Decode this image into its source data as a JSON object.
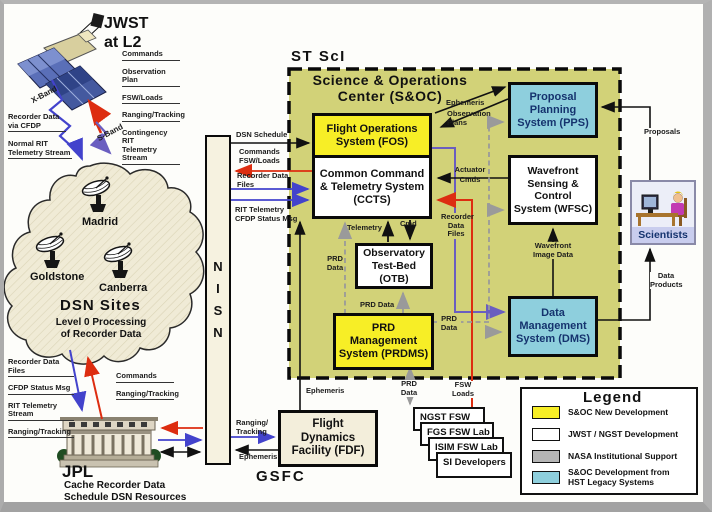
{
  "palette": {
    "soc_fill": "#d2d278",
    "new_dev_yellow": "#f7ee26",
    "hst_legacy_blue": "#8ecfdd",
    "nasa_gray": "#b5b5b5",
    "jwst_white": "#ffffff",
    "cream": "#f5f0dc",
    "red_arrow": "#dd2d10",
    "blue_arrow": "#4343cc",
    "purple_arrow": "#6a5ec0",
    "gray_dash": "#9a9a9a"
  },
  "jwst": {
    "title": "JWST\nat L2",
    "downlink": [
      "Commands",
      "Observation Plan",
      "FSW/Loads",
      "Ranging/Tracking",
      "Contingency RIT\nTelemetry Stream"
    ],
    "x_band": "X-Band",
    "s_band": "S-Band",
    "recorder_cfdp": "Recorder Data\nvia CFDP",
    "normal_rit": "Normal RIT\nTelemetry Stream"
  },
  "dsn": {
    "sites": [
      "Madrid",
      "Goldstone",
      "Canberra"
    ],
    "title": "DSN Sites",
    "subtitle": "Level 0 Processing\nof Recorder Data"
  },
  "jpl": {
    "title": "JPL",
    "caption": "Cache Recorder Data\nSchedule DSN Resources",
    "down_labels": [
      "Recorder Data Files",
      "CFDP Status Msg",
      "RIT Telemetry Stream",
      "Ranging/Tracking"
    ],
    "up_labels": [
      "Commands",
      "Ranging/Tracking"
    ]
  },
  "nisn": {
    "label": "N\nI\nS\nN"
  },
  "gsfc": {
    "fdf": "Flight\nDynamics\nFacility (FDF)",
    "label": "GSFC"
  },
  "labs": [
    "NGST FSW Lab",
    "FGS FSW Lab",
    "ISIM FSW Lab",
    "SI Developers"
  ],
  "soc": {
    "site": "ST ScI",
    "title": "Science & Operations\nCenter (S&OC)",
    "fos": "Flight Operations\nSystem (FOS)",
    "ccts": "Common Command\n& Telemetry System\n(CCTS)",
    "otb": "Observatory\nTest-Bed\n(OTB)",
    "prdms": "PRD\nManagement\nSystem (PRDMS)",
    "pps": "Proposal\nPlanning\nSystem (PPS)",
    "wfsc": "Wavefront\nSensing &\nControl\nSystem (WFSC)",
    "dms": "Data\nManagement\nSystem (DMS)"
  },
  "scientists": {
    "label": "Scientists"
  },
  "flows": {
    "dsn_schedule": "DSN Schedule",
    "commands_fsw": "Commands\nFSW/Loads",
    "recorder_files": "Recorder Data\nFiles",
    "rit_telemetry": "RIT Telemetry\nCFDP Status Msg",
    "ephemeris_v": "Ephemeris",
    "ephemeris_h": "Ephemeris",
    "ranging_tracking": "Ranging/\nTracking",
    "prd_data_ccts": "PRD\nData",
    "prd_data_otb": "PRD Data",
    "prd_data_right": "PRD\nData",
    "prd_data_labs": "PRD\nData",
    "fsw_loads": "FSW\nLoads",
    "telemetry": "Telemetry",
    "cmd": "Cmd",
    "recorder_files_dms": "Recorder\nData\nFiles",
    "actuator_cmds": "Actuator\nCmds",
    "ephemeris_pps": "Ephemeris",
    "observation_plans": "Observation\nPlans",
    "proposals": "Proposals",
    "data_products": "Data\nProducts",
    "wavefront_image": "Wavefront\nImage Data"
  },
  "legend": {
    "title": "Legend",
    "items": [
      {
        "label": "S&OC New Development",
        "color": "#f7ee26"
      },
      {
        "label": "JWST / NGST Development",
        "color": "#ffffff"
      },
      {
        "label": "NASA Institutional Support",
        "color": "#b5b5b5"
      },
      {
        "label": "S&OC Development from\nHST Legacy Systems",
        "color": "#8ecfdd"
      }
    ]
  }
}
